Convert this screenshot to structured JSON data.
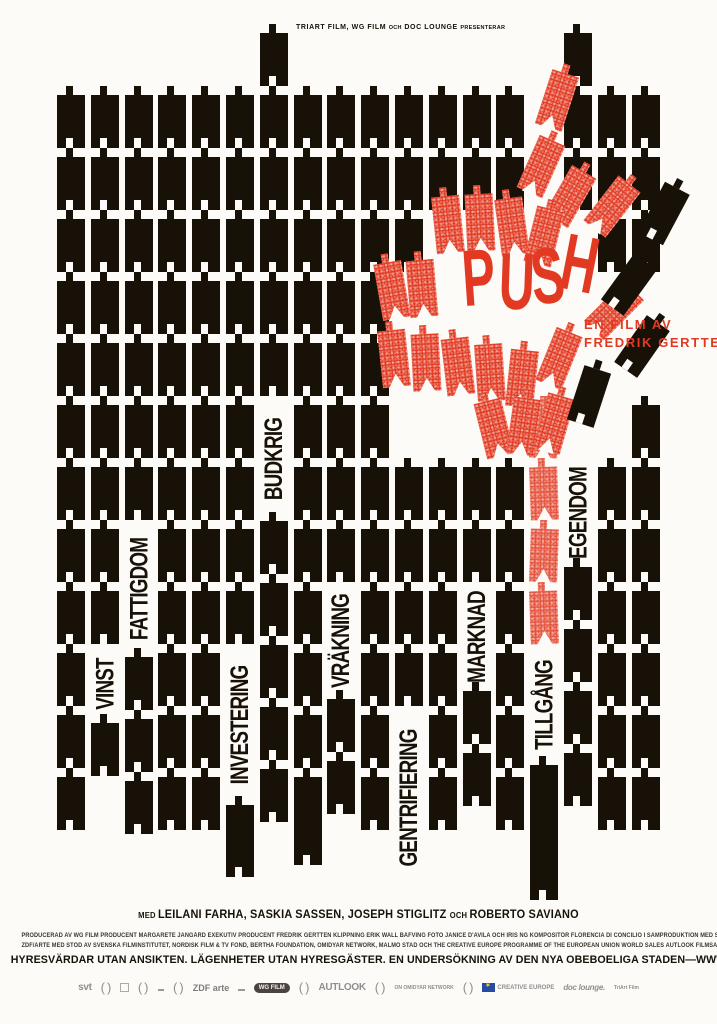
{
  "poster_title": "PUSH",
  "colors": {
    "paper": "#fcfbf8",
    "ink": "#171107",
    "red": "#e23a22"
  },
  "header": {
    "parts": [
      {
        "t": "TRIART FILM, WG FILM ",
        "small": false
      },
      {
        "t": "OCH",
        "small": true
      },
      {
        "t": " DOC LOUNGE ",
        "small": false
      },
      {
        "t": "PRESENTERAR",
        "small": true
      }
    ]
  },
  "film_credit": {
    "line1": "EN FILM AV",
    "line2": "FREDRIK GERTTEN"
  },
  "push_letters": [
    {
      "ch": "P",
      "x": 452,
      "y": 238,
      "rot": -4
    },
    {
      "ch": "U",
      "x": 488,
      "y": 242,
      "rot": 2
    },
    {
      "ch": "S",
      "x": 521,
      "y": 236,
      "rot": -6
    },
    {
      "ch": "H",
      "x": 551,
      "y": 224,
      "rot": 11
    }
  ],
  "grid": {
    "top_default": 95,
    "columns": [
      {
        "items": [
          [
            "b",
            12
          ]
        ]
      },
      {
        "items": [
          [
            "b",
            9
          ],
          [
            "w",
            "VINST",
            70
          ],
          [
            "b",
            1
          ]
        ]
      },
      {
        "items": [
          [
            "b",
            7
          ],
          [
            "w",
            "FATTIGDOM",
            128
          ],
          [
            "b",
            3
          ]
        ]
      },
      {
        "items": [
          [
            "b",
            12
          ]
        ]
      },
      {
        "items": [
          [
            "b",
            12
          ]
        ]
      },
      {
        "items": [
          [
            "b",
            9
          ],
          [
            "w",
            "INVESTERING",
            152
          ],
          [
            "bh",
            72
          ]
        ]
      },
      {
        "mt": 33,
        "items": [
          [
            "b",
            6
          ],
          [
            "w",
            "BUDKRIG",
            116
          ],
          [
            "b",
            5
          ]
        ]
      },
      {
        "items": [
          [
            "b",
            11
          ],
          [
            "bh",
            88
          ]
        ]
      },
      {
        "items": [
          [
            "b",
            8
          ],
          [
            "w",
            "VRÄKNING",
            108
          ],
          [
            "b",
            2
          ]
        ]
      },
      {
        "items": [
          [
            "b",
            12
          ]
        ]
      },
      {
        "items": [
          [
            "b",
            3
          ],
          [
            "g",
            186
          ],
          [
            "b",
            4
          ],
          [
            "w",
            "GENTRIFIERING",
            175
          ]
        ]
      },
      {
        "items": [
          [
            "b",
            2
          ],
          [
            "g",
            248
          ],
          [
            "b",
            6
          ]
        ]
      },
      {
        "items": [
          [
            "b",
            2
          ],
          [
            "g",
            248
          ],
          [
            "b",
            2
          ],
          [
            "w",
            "MARKNAD",
            100
          ],
          [
            "b",
            2
          ]
        ]
      },
      {
        "items": [
          [
            "b",
            2
          ],
          [
            "g",
            248
          ],
          [
            "b",
            6
          ]
        ]
      },
      {
        "items": [
          [
            "g",
            310
          ],
          [
            "r",
            4
          ],
          [
            "w",
            "TILLGÅNG",
            112
          ],
          [
            "bh",
            135
          ]
        ]
      },
      {
        "mt": 33,
        "items": [
          [
            "b",
            3
          ],
          [
            "g",
            248
          ],
          [
            "w",
            "EGENDOM",
            100
          ],
          [
            "b",
            4
          ]
        ]
      },
      {
        "items": [
          [
            "b",
            3
          ],
          [
            "g",
            186
          ],
          [
            "b",
            6
          ]
        ]
      },
      {
        "items": [
          [
            "b",
            3
          ],
          [
            "g",
            124
          ],
          [
            "b",
            7
          ]
        ]
      }
    ]
  },
  "chaos_blocks": [
    {
      "x": 543,
      "y": 72,
      "rot": 18,
      "kind": "red"
    },
    {
      "x": 527,
      "y": 138,
      "rot": 24,
      "kind": "red"
    },
    {
      "x": 556,
      "y": 168,
      "rot": 30,
      "kind": "red"
    },
    {
      "x": 598,
      "y": 178,
      "rot": 38,
      "kind": "red"
    },
    {
      "x": 434,
      "y": 196,
      "rot": -6,
      "kind": "red"
    },
    {
      "x": 466,
      "y": 194,
      "rot": -3,
      "kind": "red"
    },
    {
      "x": 498,
      "y": 198,
      "rot": -8,
      "kind": "red"
    },
    {
      "x": 530,
      "y": 208,
      "rot": 14,
      "kind": "red"
    },
    {
      "x": 378,
      "y": 262,
      "rot": -10,
      "kind": "red"
    },
    {
      "x": 408,
      "y": 260,
      "rot": -5,
      "kind": "red"
    },
    {
      "x": 600,
      "y": 282,
      "rot": 45,
      "kind": "red"
    },
    {
      "x": 380,
      "y": 330,
      "rot": -6,
      "kind": "red"
    },
    {
      "x": 412,
      "y": 334,
      "rot": -3,
      "kind": "red"
    },
    {
      "x": 444,
      "y": 338,
      "rot": -7,
      "kind": "red"
    },
    {
      "x": 476,
      "y": 344,
      "rot": -4,
      "kind": "red"
    },
    {
      "x": 508,
      "y": 350,
      "rot": 6,
      "kind": "red"
    },
    {
      "x": 545,
      "y": 330,
      "rot": 22,
      "kind": "red"
    },
    {
      "x": 480,
      "y": 400,
      "rot": -14,
      "kind": "red"
    },
    {
      "x": 510,
      "y": 398,
      "rot": 8,
      "kind": "red"
    },
    {
      "x": 540,
      "y": 395,
      "rot": 16,
      "kind": "red"
    },
    {
      "x": 650,
      "y": 185,
      "rot": 28,
      "kind": "black"
    },
    {
      "x": 615,
      "y": 256,
      "rot": 36,
      "kind": "black"
    },
    {
      "x": 628,
      "y": 318,
      "rot": 35,
      "kind": "black"
    },
    {
      "x": 575,
      "y": 368,
      "rot": 18,
      "kind": "black"
    }
  ],
  "footer": {
    "names_parts": [
      {
        "t": "MED ",
        "small": true
      },
      {
        "t": "LEILANI FARHA, SASKIA SASSEN, JOSEPH STIGLITZ ",
        "small": false
      },
      {
        "t": "OCH ",
        "small": true
      },
      {
        "t": "ROBERTO SAVIANO",
        "small": false
      }
    ],
    "credit_line_1": "PRODUCERAD AV WG FILM PRODUCENT MARGARETE JANGÅRD EXEKUTIV PRODUCENT FREDRIK GERTTEN KLIPPNING ERIK WALL BÄFVING FOTO JANICE D'AVILA OCH IRIS NG KOMPOSITÖR FLORENCIA DI CONCILIO I SAMPRODUKTION MED SVT, FILM I SKÅNE,",
    "credit_line_2": "ZDF/ARTE MED STÖD AV SVENSKA FILMINSTITUTET, NORDISK FILM & TV FOND, BERTHA FOUNDATION, OMIDYAR NETWORK, MALMÖ STAD OCH THE CREATIVE EUROPE PROGRAMME OF THE EUROPEAN UNION WORLD SALES AUTLOOK FILMSALES",
    "tagline": "HYRESVÄRDAR UTAN ANSIKTEN. LÄGENHETER UTAN HYRESGÄSTER. EN UNDERSÖKNING AV DEN NYA OBEBOELIGA STADEN—WWW.PUSHTHEFILM.COM",
    "logos": [
      {
        "kind": "text",
        "label": "svt"
      },
      {
        "kind": "laurel",
        "label": ""
      },
      {
        "kind": "box",
        "label": ""
      },
      {
        "kind": "laurel",
        "label": ""
      },
      {
        "kind": "mark",
        "label": ""
      },
      {
        "kind": "laurel",
        "label": ""
      },
      {
        "kind": "text-strong",
        "label": "ZDF arte"
      },
      {
        "kind": "mark",
        "label": ""
      },
      {
        "kind": "oval",
        "label": "WG FILM"
      },
      {
        "kind": "laurel",
        "label": ""
      },
      {
        "kind": "text",
        "label": "AUTLOOK"
      },
      {
        "kind": "laurel",
        "label": ""
      },
      {
        "kind": "text-tiny",
        "label": "ON OMIDYAR NETWORK"
      },
      {
        "kind": "laurel",
        "label": ""
      },
      {
        "kind": "eu",
        "label": "CREATIVE EUROPE"
      },
      {
        "kind": "script",
        "label": "doc lounge."
      },
      {
        "kind": "text-tiny",
        "label": "TriArt Film"
      }
    ]
  }
}
